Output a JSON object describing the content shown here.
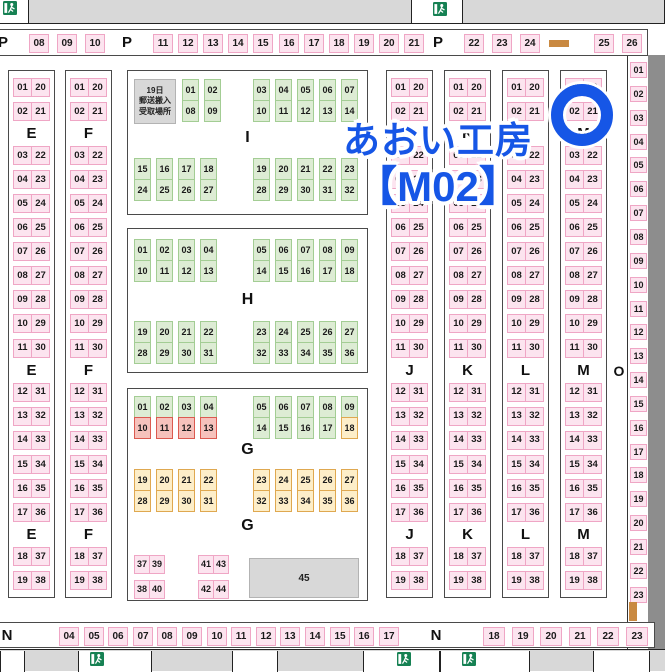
{
  "title": {
    "line1": "あおい工房",
    "line2": "【M02】"
  },
  "colors": {
    "blue": "#1656e6",
    "pink_fill": "#fce4ef",
    "pink_border": "#efa6c5",
    "green_fill": "#ddecd4",
    "green_border": "#a3cd94",
    "orange_fill": "#fdeec9",
    "orange_border": "#dfa850",
    "red_fill": "#f6c2bc",
    "red_border": "#db5a50",
    "gray": "#d8d8d8",
    "wall": "#8d8d8d",
    "door_bar": "#c98941",
    "exit_green": "#168153"
  },
  "p_row": {
    "label": "P",
    "group1": [
      "08",
      "09",
      "10"
    ],
    "group2": [
      "11",
      "12",
      "13",
      "14",
      "15",
      "16",
      "17",
      "18",
      "19",
      "20",
      "21"
    ],
    "group3": [
      "22",
      "23",
      "24"
    ],
    "group4": [
      "25",
      "26"
    ]
  },
  "strips": {
    "names": [
      "E",
      "F",
      "J",
      "K",
      "L",
      "M"
    ],
    "rows": [
      [
        "01",
        "20"
      ],
      [
        "02",
        "21"
      ],
      "LABEL",
      [
        "03",
        "22"
      ],
      [
        "04",
        "23"
      ],
      [
        "05",
        "24"
      ],
      [
        "06",
        "25"
      ],
      [
        "07",
        "26"
      ],
      [
        "08",
        "27"
      ],
      [
        "09",
        "28"
      ],
      [
        "10",
        "29"
      ],
      [
        "11",
        "30"
      ],
      "LABEL",
      [
        "12",
        "31"
      ],
      [
        "13",
        "32"
      ],
      [
        "14",
        "33"
      ],
      [
        "15",
        "34"
      ],
      [
        "16",
        "35"
      ],
      [
        "17",
        "36"
      ],
      "LABEL",
      [
        "18",
        "37"
      ],
      [
        "19",
        "38"
      ]
    ]
  },
  "block_i": {
    "label": "I",
    "pickup_lines": [
      "19日",
      "郵送搬入",
      "受取場所"
    ],
    "top_left": [
      [
        "01",
        "08"
      ],
      [
        "02",
        "09"
      ]
    ],
    "top_right": [
      [
        "03",
        "10"
      ],
      [
        "04",
        "11"
      ],
      [
        "05",
        "12"
      ],
      [
        "06",
        "13"
      ],
      [
        "07",
        "14"
      ]
    ],
    "bottom_left": [
      [
        "15",
        "24"
      ],
      [
        "16",
        "25"
      ],
      [
        "17",
        "26"
      ],
      [
        "18",
        "27"
      ]
    ],
    "bottom_right": [
      [
        "19",
        "28"
      ],
      [
        "20",
        "29"
      ],
      [
        "21",
        "30"
      ],
      [
        "22",
        "31"
      ],
      [
        "23",
        "32"
      ]
    ]
  },
  "block_h": {
    "label": "H",
    "top_left": [
      [
        "01",
        "10"
      ],
      [
        "02",
        "11"
      ],
      [
        "03",
        "12"
      ],
      [
        "04",
        "13"
      ]
    ],
    "top_right": [
      [
        "05",
        "14"
      ],
      [
        "06",
        "15"
      ],
      [
        "07",
        "16"
      ],
      [
        "08",
        "17"
      ],
      [
        "09",
        "18"
      ]
    ],
    "bottom_left": [
      [
        "19",
        "28"
      ],
      [
        "20",
        "29"
      ],
      [
        "21",
        "30"
      ],
      [
        "22",
        "31"
      ]
    ],
    "bottom_right": [
      [
        "23",
        "32"
      ],
      [
        "24",
        "33"
      ],
      [
        "25",
        "34"
      ],
      [
        "26",
        "35"
      ],
      [
        "27",
        "36"
      ]
    ]
  },
  "block_g": {
    "label": "G",
    "top_left": [
      [
        [
          "01",
          "green"
        ],
        [
          "10",
          "red"
        ]
      ],
      [
        [
          "02",
          "green"
        ],
        [
          "11",
          "red"
        ]
      ],
      [
        [
          "03",
          "green"
        ],
        [
          "12",
          "red"
        ]
      ],
      [
        [
          "04",
          "green"
        ],
        [
          "13",
          "red"
        ]
      ]
    ],
    "top_right": [
      [
        [
          "05",
          "green"
        ],
        [
          "14",
          "green"
        ]
      ],
      [
        [
          "06",
          "green"
        ],
        [
          "15",
          "green"
        ]
      ],
      [
        [
          "07",
          "green"
        ],
        [
          "16",
          "green"
        ]
      ],
      [
        [
          "08",
          "green"
        ],
        [
          "17",
          "green"
        ]
      ],
      [
        [
          "09",
          "green"
        ],
        [
          "18",
          "orange"
        ]
      ]
    ],
    "bottom_left": [
      [
        "19",
        "28"
      ],
      [
        "20",
        "29"
      ],
      [
        "21",
        "30"
      ],
      [
        "22",
        "31"
      ]
    ],
    "bottom_right": [
      [
        "23",
        "32"
      ],
      [
        "24",
        "33"
      ],
      [
        "25",
        "34"
      ],
      [
        "26",
        "35"
      ],
      [
        "27",
        "36"
      ]
    ],
    "footer": {
      "pairs_a": [
        [
          "37",
          "39"
        ],
        [
          "38",
          "40"
        ]
      ],
      "pairs_b": [
        [
          "41",
          "43"
        ],
        [
          "42",
          "44"
        ]
      ],
      "box_label": "45"
    }
  },
  "o_col": {
    "label": "O",
    "cells": [
      "01",
      "02",
      "03",
      "04",
      "05",
      "06",
      "07",
      "08",
      "09",
      "10",
      "11",
      "12",
      "13",
      "14",
      "15",
      "16",
      "17",
      "18",
      "19",
      "20",
      "21",
      "22",
      "23"
    ]
  },
  "n_row": {
    "label": "N",
    "group1": [
      "04",
      "05",
      "06",
      "07",
      "08",
      "09",
      "10",
      "11",
      "12",
      "13",
      "14",
      "15",
      "16",
      "17"
    ],
    "group2": [
      "18",
      "19",
      "20",
      "21",
      "22",
      "23"
    ]
  }
}
